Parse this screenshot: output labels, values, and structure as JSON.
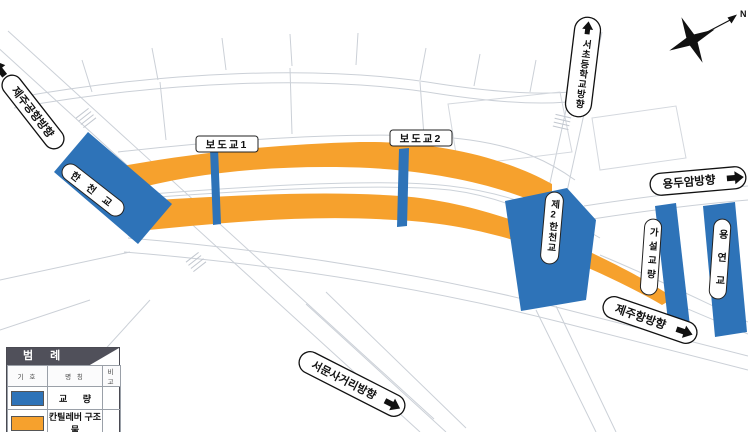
{
  "colors": {
    "cantilever_orange": "#F6A12D",
    "bridge_blue": "#2E73B8",
    "road_line": "#cbd0d7"
  },
  "compass": {
    "north_label": "N"
  },
  "direction_pills": {
    "jeju_airport": {
      "label": "제주공항방향"
    },
    "seo_elementary_school": {
      "label": "서초등학교방향"
    },
    "yongduam": {
      "label": "용두암방향"
    },
    "jeju_port": {
      "label": "제주항방향"
    },
    "seomun_intersection": {
      "label": "서문사거리방향"
    }
  },
  "bridge_labels": {
    "hancheon_bridge": "한 천 교",
    "pedestrian_bridge_1": "보도교1",
    "pedestrian_bridge_2": "보도교2",
    "second_hancheon_bridge": "제2한천교",
    "temporary_bridge": "가설교량",
    "yongyeon_bridge": "용연교"
  },
  "legend": {
    "title": "범 례",
    "columns": [
      "기 호",
      "명 칭",
      "비 고"
    ],
    "rows": [
      {
        "name": "교 량",
        "color": "#2E73B8",
        "note": ""
      },
      {
        "name": "칸틸레버 구조물",
        "color": "#F6A12D",
        "note": ""
      }
    ]
  }
}
